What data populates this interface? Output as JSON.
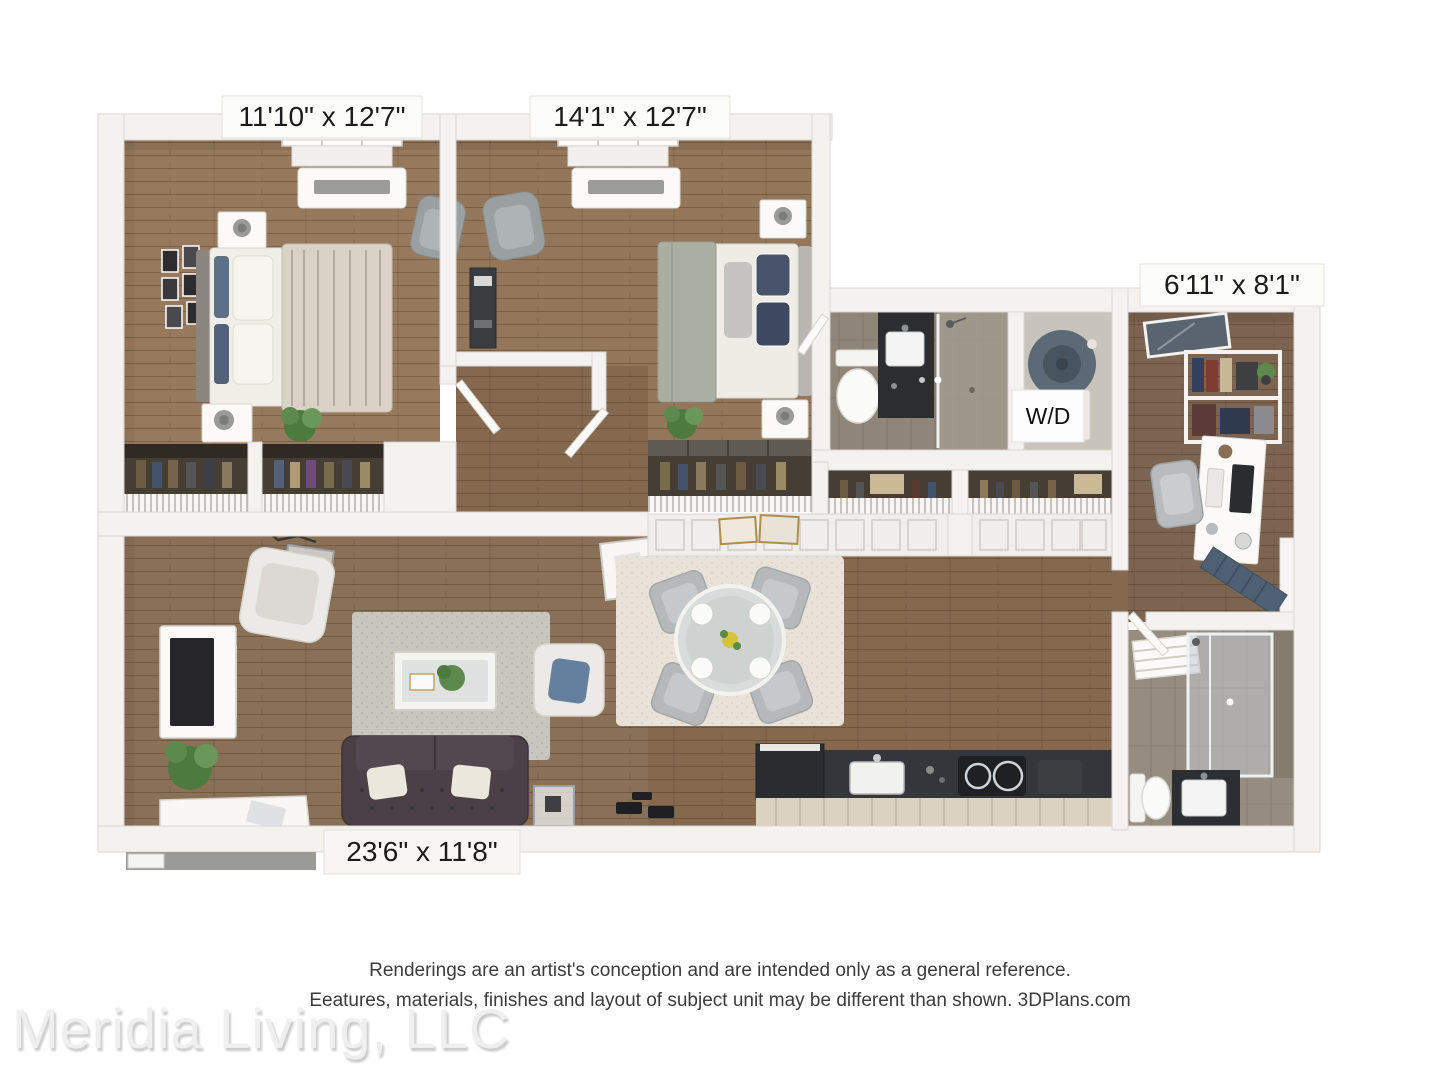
{
  "page": {
    "background": "#ffffff"
  },
  "floorplan": {
    "type": "3d-floor-plan",
    "rooms": [
      {
        "id": "bedroom-1",
        "dimensions": "11'10\" x 12'7\""
      },
      {
        "id": "bedroom-2",
        "dimensions": "14'1\" x 12'7\""
      },
      {
        "id": "den",
        "dimensions": "6'11\" x 8'1\""
      },
      {
        "id": "living-room",
        "dimensions": "23'6\" x 11'8\""
      }
    ],
    "labels": {
      "washer_dryer": "W/D"
    },
    "palette": {
      "wall": "#f3f2ef",
      "wall_edge": "#d9d7d3",
      "wood_light": "#96785c",
      "wood_mid": "#8a7057",
      "wood_dark": "#7c6450",
      "tile": "#8f8679",
      "sofa": "#4a4046",
      "rug_living": "#c9c5bf",
      "rug_dining": "#e8e2d8",
      "accent_blue": "#64809c",
      "counter": "#33363a",
      "counter_front": "#dbd1bf",
      "entry_door": "#4e6174",
      "washer": "#5b6a76"
    }
  },
  "footer": {
    "disclaimer_line1": "Renderings are an artist's conception and are intended only as a general reference.",
    "disclaimer_line2": "Eeatures, materials, finishes and layout of subject unit may be different than shown. 3DPlans.com",
    "watermark": "Meridia Living, LLC"
  }
}
